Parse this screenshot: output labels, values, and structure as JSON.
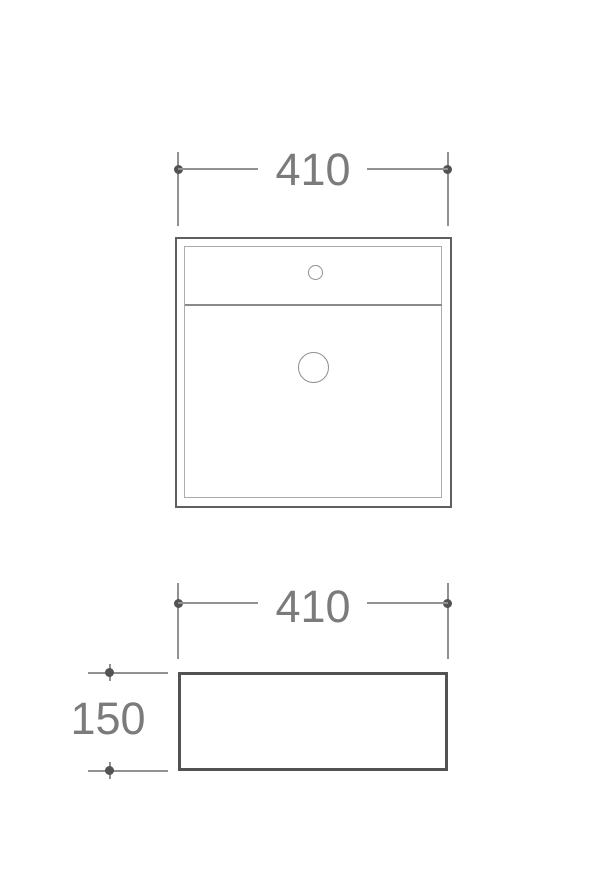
{
  "drawing": {
    "type": "technical-dimension-drawing",
    "subject": "square countertop basin, plan view and front view",
    "dimensions": {
      "plan_width": "410",
      "front_width": "410",
      "front_height": "150"
    },
    "features": {
      "tap_hole": "tap-hole",
      "drain_hole": "drain-hole"
    },
    "colors": {
      "background": "#ffffff",
      "dim_line": "#919191",
      "dim_dot": "#535353",
      "dim_text": "#7b7b7b",
      "plan_outline": "#5f5f5f",
      "plan_inner": "#ababab",
      "divider_line": "#8a8a8a",
      "hole_line": "#8f8f8f",
      "front_outline": "#525252"
    }
  }
}
